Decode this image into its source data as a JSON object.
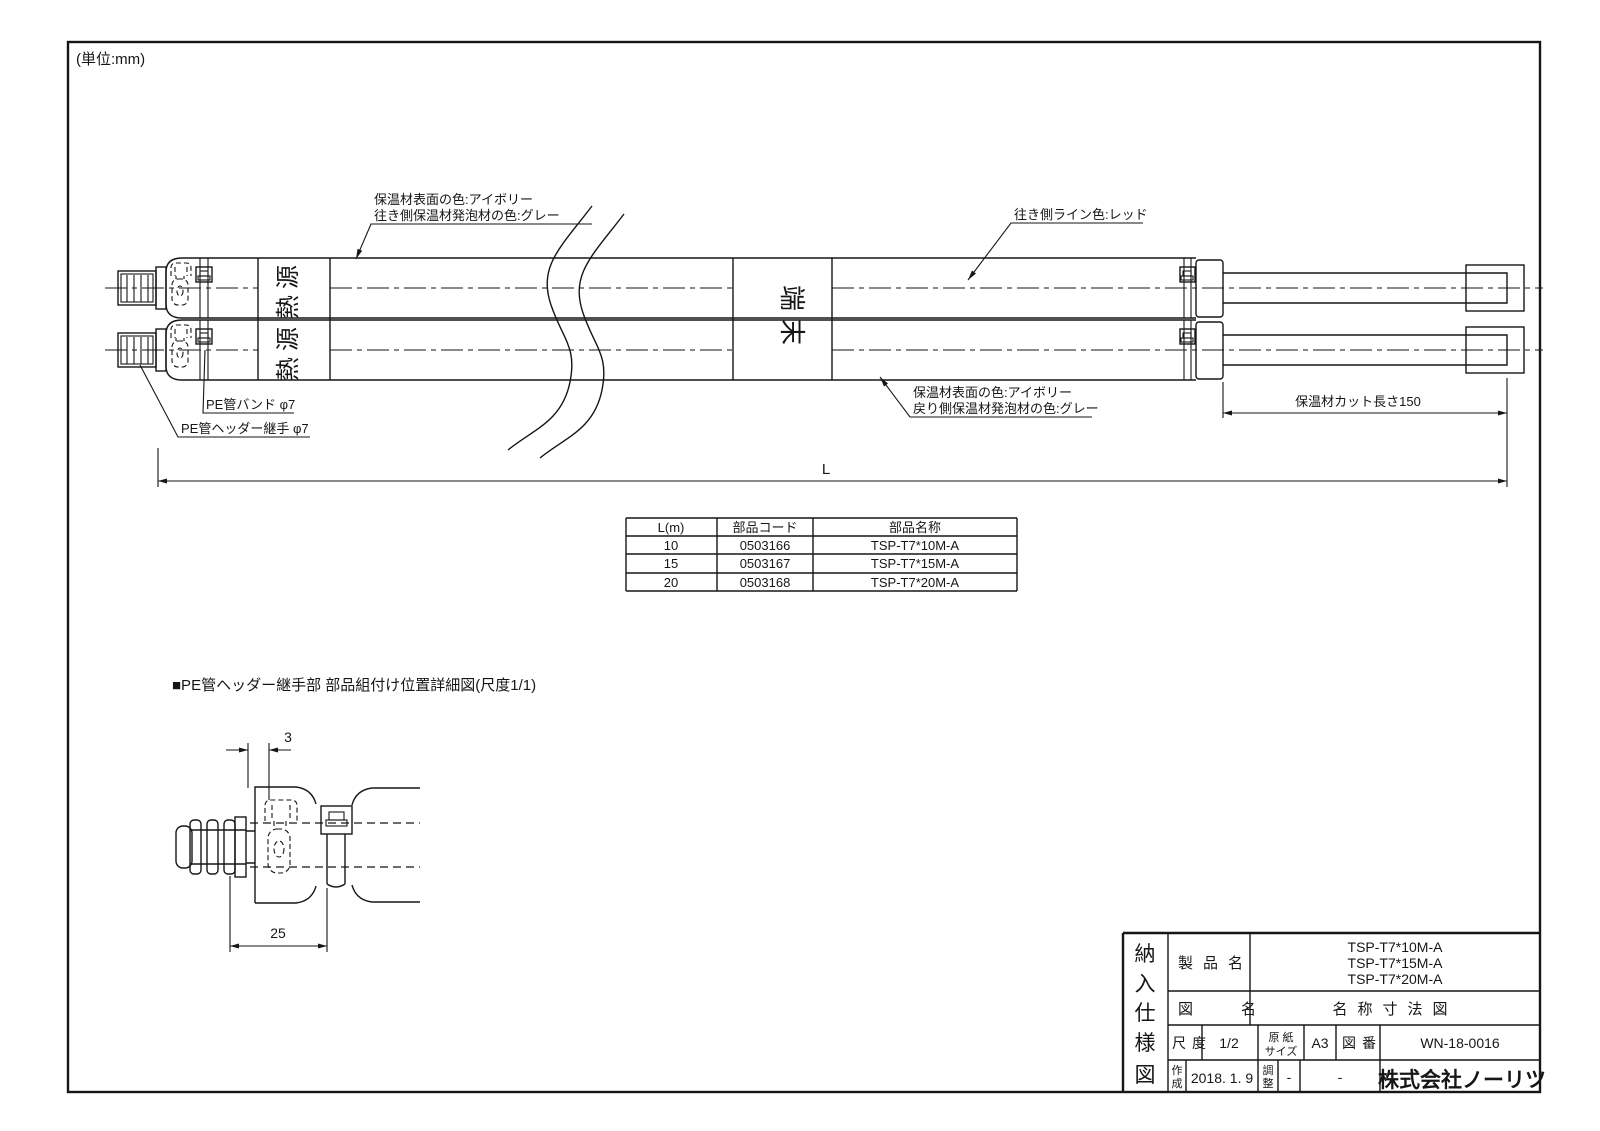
{
  "page": {
    "unit_note": "(単位:mm)"
  },
  "main_view": {
    "marks": {
      "heat_source": "熱源",
      "terminal": "端末"
    },
    "callouts": {
      "outbound_insulation_line1": "保温材表面の色:アイボリー",
      "outbound_insulation_line2": "往き側保温材発泡材の色:グレー",
      "outbound_stripe": "往き側ライン色:レッド",
      "return_insulation_line1": "保温材表面の色:アイボリー",
      "return_insulation_line2": "戻り側保温材発泡材の色:グレー",
      "pe_band": "PE管バンド φ7",
      "pe_header_joint": "PE管ヘッダー継手 φ7"
    },
    "dimensions": {
      "insulation_cut": "保温材カット長さ150",
      "total_length": "L"
    }
  },
  "parts_table": {
    "headers": [
      "L(m)",
      "部品コード",
      "部品名称"
    ],
    "rows": [
      [
        "10",
        "0503166",
        "TSP-T7*10M-A"
      ],
      [
        "15",
        "0503167",
        "TSP-T7*15M-A"
      ],
      [
        "20",
        "0503168",
        "TSP-T7*20M-A"
      ]
    ]
  },
  "detail_view": {
    "title": "■PE管ヘッダー継手部 部品組付け位置詳細図(尺度1/1)",
    "dims": {
      "offset": "3",
      "pitch": "25"
    }
  },
  "title_block": {
    "doc_type_chars": [
      "納",
      "入",
      "仕",
      "様",
      "図"
    ],
    "product_label": "製品名",
    "product_names": [
      "TSP-T7*10M-A",
      "TSP-T7*15M-A",
      "TSP-T7*20M-A"
    ],
    "drawing_name_label": "図名",
    "drawing_name": "名称寸法図",
    "scale_label": "尺度",
    "scale_value": "1/2",
    "paper_label_line1": "原 紙",
    "paper_label_line2": "サイズ",
    "paper_value": "A3",
    "number_label": "図番",
    "number_value": "WN-18-0016",
    "created_label_chars": [
      "作",
      "成"
    ],
    "created_date": "2018. 1. 9",
    "adjust_label_chars": [
      "調",
      "整"
    ],
    "adjust_value": "-",
    "extra_value": "-",
    "company": "株式会社ノーリツ"
  }
}
